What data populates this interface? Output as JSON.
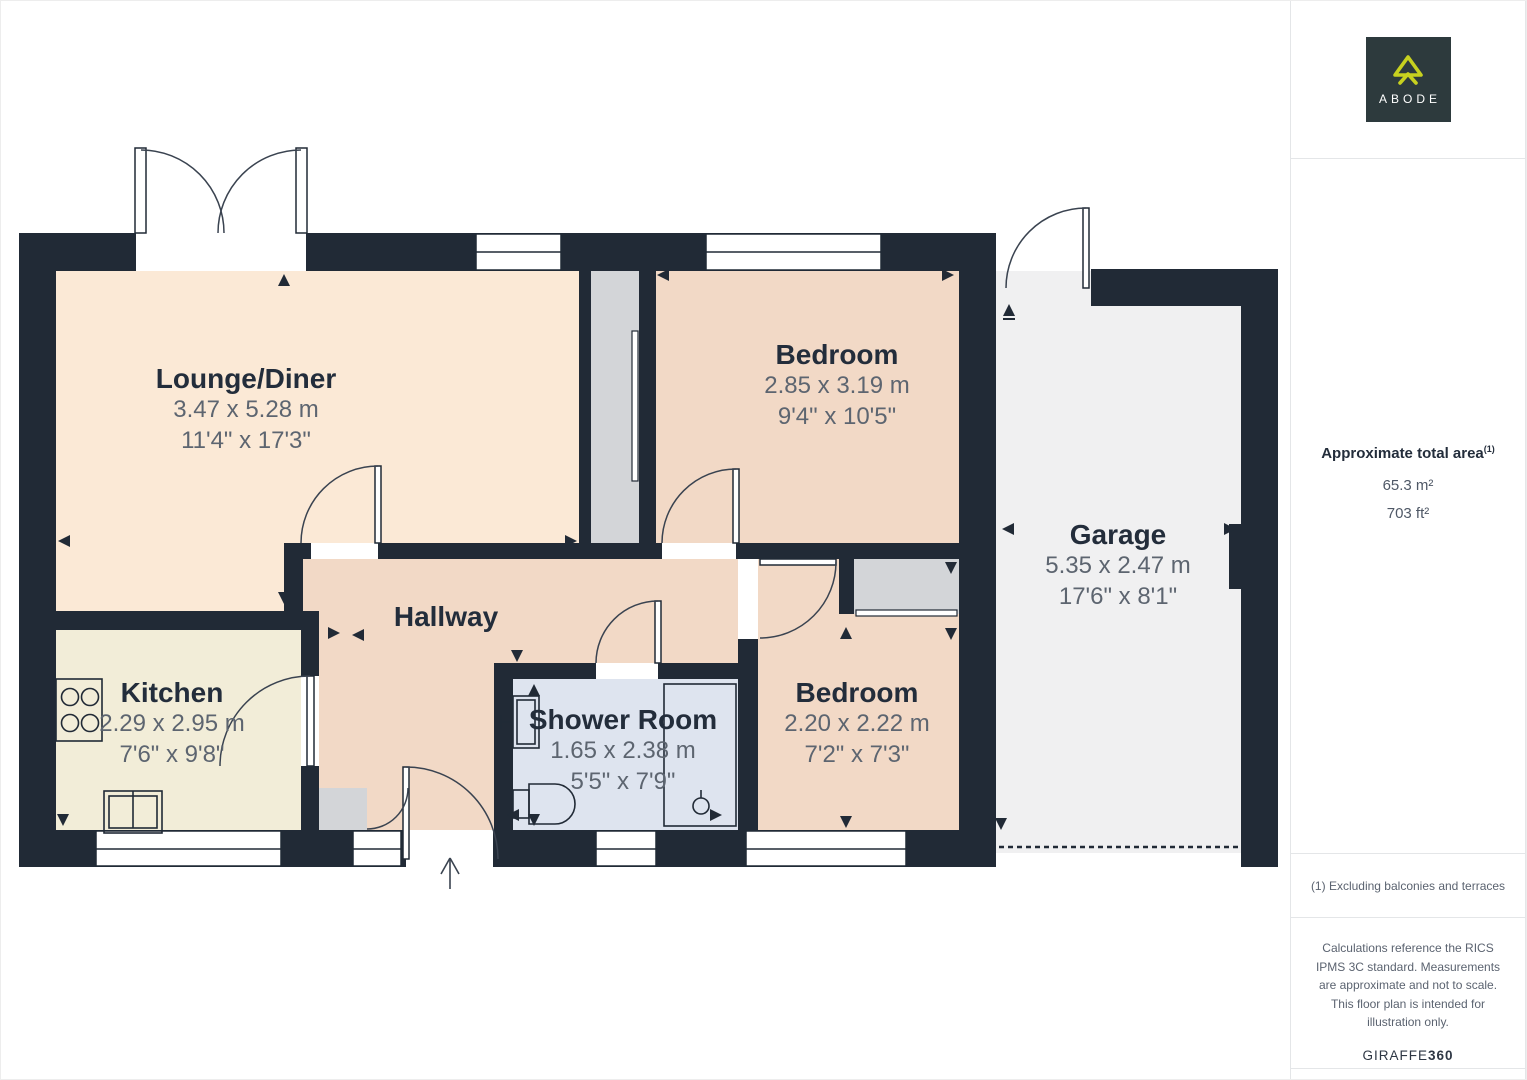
{
  "floorplan": {
    "rooms": [
      {
        "id": "lounge",
        "name": "Lounge/Diner",
        "metric": "3.47 x 5.28 m",
        "imperial": "11'4\" x 17'3\""
      },
      {
        "id": "bedroom1",
        "name": "Bedroom",
        "metric": "2.85 x 3.19 m",
        "imperial": "9'4\" x 10'5\""
      },
      {
        "id": "kitchen",
        "name": "Kitchen",
        "metric": "2.29 x 2.95 m",
        "imperial": "7'6\" x 9'8\""
      },
      {
        "id": "hallway",
        "name": "Hallway",
        "metric": "",
        "imperial": ""
      },
      {
        "id": "shower",
        "name": "Shower Room",
        "metric": "1.65 x 2.38 m",
        "imperial": "5'5\" x 7'9\""
      },
      {
        "id": "bedroom2",
        "name": "Bedroom",
        "metric": "2.20 x 2.22 m",
        "imperial": "7'2\" x 7'3\""
      },
      {
        "id": "garage",
        "name": "Garage",
        "metric": "5.35 x 2.47 m",
        "imperial": "17'6\" x 8'1\""
      }
    ],
    "colors": {
      "wall": "#212a36",
      "lounge_fill": "#fbe9d6",
      "bedroom_hall_fill": "#f2d9c6",
      "kitchen_fill": "#f2edd8",
      "shower_fill": "#dee4ef",
      "garage_fill": "#f0f0f1",
      "cupboard_fill": "#d3d5d8"
    }
  },
  "sidebar": {
    "logo": {
      "brand": "ABODE",
      "bg": "#2d3a3d",
      "accent": "#c7d11f"
    },
    "area": {
      "heading": "Approximate total area",
      "superscript": "(1)",
      "metric": "65.3 m²",
      "imperial": "703 ft²"
    },
    "footnote": "(1) Excluding balconies and terraces",
    "disclaimer": "Calculations reference the RICS IPMS 3C standard. Measurements are approximate and not to scale. This floor plan is intended for illustration only.",
    "credit_brand": "GIRAFFE",
    "credit_suffix": "360"
  }
}
